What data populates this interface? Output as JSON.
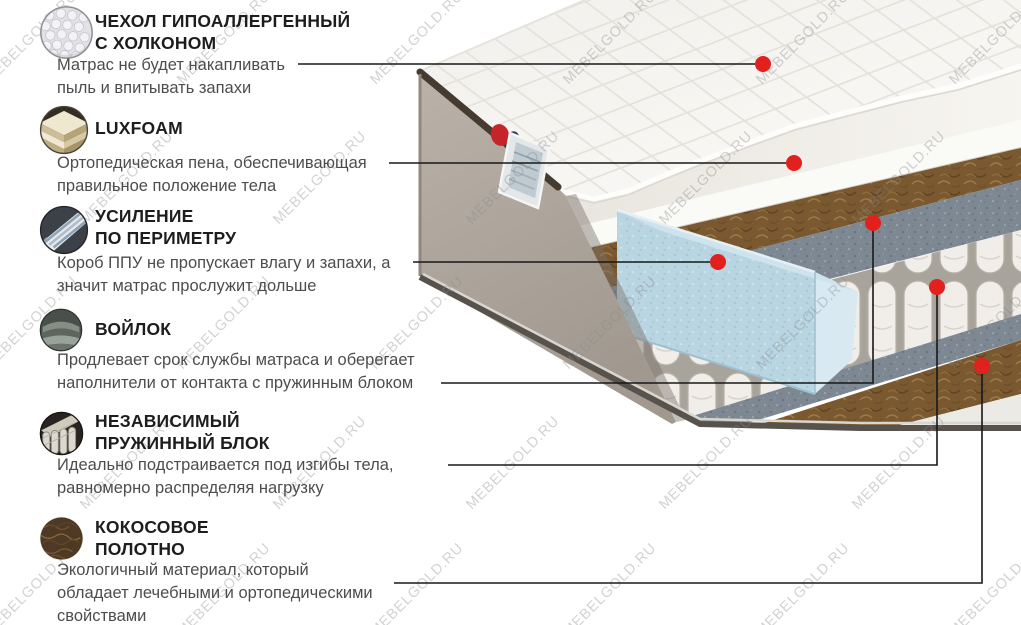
{
  "watermark": {
    "text": "MEBELGOLD.RU"
  },
  "colors": {
    "marker_red": "#e2201d",
    "connector_black": "#181818",
    "heading_text": "#1d1d1d",
    "body_text": "#4d4d4d",
    "side_fabric_beige": "#b2a99f",
    "perimeter_foam_blue": "#bdd8e4",
    "coconut_brown": "#7a5930",
    "felt_gray": "#7e8893"
  },
  "sections": [
    {
      "icon": "quilted-cover-icon",
      "title": "ЧЕХОЛ ГИПОАЛЛЕРГЕННЫЙ\nС ХОЛКОНОМ",
      "desc": "Матрас не будет накапливать\nпыль и впитывать запахи"
    },
    {
      "icon": "foam-layers-icon",
      "title": "LUXFOAM",
      "desc": "Ортопедическая пена, обеспечивающая\nправильное положение тела"
    },
    {
      "icon": "perimeter-foam-icon",
      "title": "УСИЛЕНИЕ\nПО ПЕРИМЕТРУ",
      "desc": "Короб ППУ не пропускает влагу и запахи, а\nзначит матрас прослужит дольше"
    },
    {
      "icon": "felt-icon",
      "title": "ВОЙЛОК",
      "desc": "Продлевает срок службы матраса и оберегает\nнаполнители от контакта с пружинным блоком"
    },
    {
      "icon": "pocket-springs-icon",
      "title": "НЕЗАВИСИМЫЙ\nПРУЖИННЫЙ БЛОК",
      "desc": "Идеально подстраивается под изгибы тела,\nравномерно распределяя нагрузку"
    },
    {
      "icon": "coconut-coir-icon",
      "title": "КОКОСОВОЕ\nПОЛОТНО",
      "desc": "Экологичный материал, который\nобладает лечебными и ортопедическими\nсвойствами"
    }
  ]
}
